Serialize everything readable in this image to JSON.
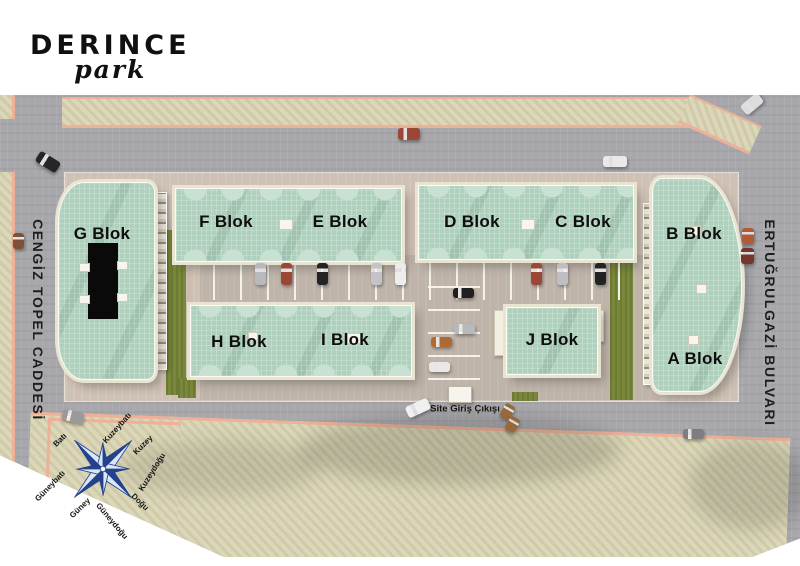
{
  "logo": {
    "brand": "DERINCE",
    "sub": "park"
  },
  "streets": {
    "left": "CENGİZ TOPEL CADDESİ",
    "right": "ERTUĞRULGAZİ BULVARI"
  },
  "blocks": {
    "a": "A Blok",
    "b": "B Blok",
    "c": "C Blok",
    "d": "D Blok",
    "e": "E Blok",
    "f": "F Blok",
    "g": "G Blok",
    "h": "H Blok",
    "i": "I Blok",
    "j": "J Blok"
  },
  "entrance": {
    "label": "Site Giriş Çıkışı"
  },
  "compass": {
    "n": "Kuzey",
    "ne": "Kuzeydoğu",
    "e": "Doğu",
    "se": "Güneydoğu",
    "s": "Güney",
    "sw": "Güneybatı",
    "w": "Batı",
    "nw": "Kuzeybatı"
  },
  "colors": {
    "roof_green": "#aed0bd",
    "road_gray": "#a8a8ac",
    "sidewalk_beige": "#dbd7b8",
    "curb_salmon": "#eeb096",
    "ground_tan": "#cfc1b4",
    "grass_olive": "#79883a",
    "compass_blue": "#24418e"
  }
}
